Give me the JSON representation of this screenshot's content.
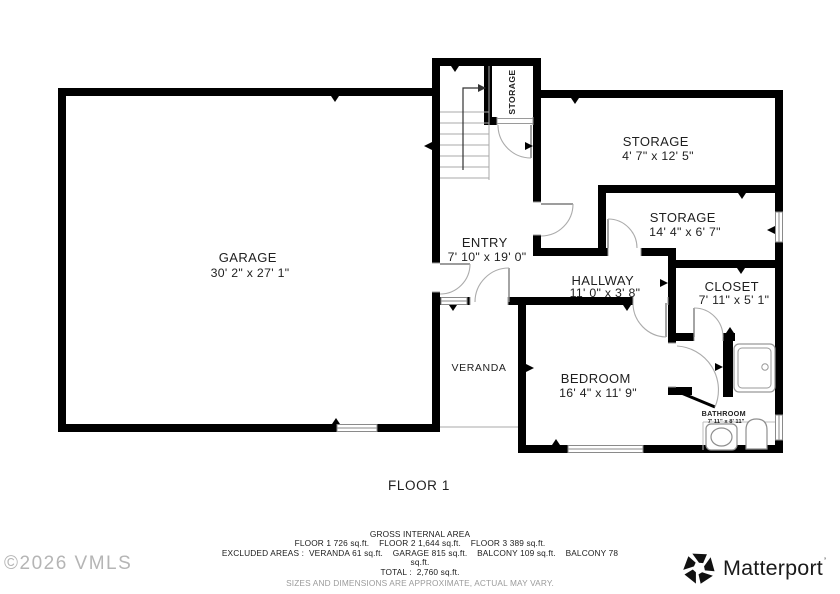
{
  "colors": {
    "wall": "#000000",
    "thin_line": "#9a9a9a",
    "label_text": "#1f1f1f",
    "muted_text": "#9b9b9b",
    "watermark": "#b5b5b5",
    "brand": "#1a1a1a"
  },
  "rooms": {
    "garage": {
      "name": "GARAGE",
      "dims": "30' 2\" x 27' 1\""
    },
    "entry": {
      "name": "ENTRY",
      "dims": "7' 10\" x 19' 0\""
    },
    "storage_closet": {
      "name": "STORAGE"
    },
    "storage_upper": {
      "name": "STORAGE",
      "dims": "4' 7\" x 12' 5\""
    },
    "storage_lower": {
      "name": "STORAGE",
      "dims": "14' 4\" x 6' 7\""
    },
    "closet": {
      "name": "CLOSET",
      "dims": "7' 11\" x 5' 1\""
    },
    "hallway": {
      "name": "HALLWAY",
      "dims": "11' 0\" x 3' 8\""
    },
    "bedroom": {
      "name": "BEDROOM",
      "dims": "16' 4\" x 11' 9\""
    },
    "bathroom": {
      "name": "BATHROOM",
      "dims": "7' 11\" x 8' 11\""
    },
    "veranda": {
      "name": "VERANDA"
    }
  },
  "floor_label": "FLOOR 1",
  "footer": {
    "title": "GROSS INTERNAL AREA",
    "line1": "FLOOR 1 726 sq.ft.    FLOOR 2 1,644 sq.ft.    FLOOR 3 389 sq.ft.",
    "line2": "EXCLUDED AREAS :  VERANDA 61 sq.ft.    GARAGE 815 sq.ft.    BALCONY 109 sq.ft.    BALCONY 78",
    "line2_wrap": "sq.ft.",
    "line3": "TOTAL :  2,760 sq.ft.",
    "disclaimer": "SIZES AND DIMENSIONS ARE APPROXIMATE, ACTUAL MAY VARY."
  },
  "watermark": "©2026 VMLS",
  "brand": {
    "wordmark": "Matterport",
    "tm_mark": "’"
  }
}
